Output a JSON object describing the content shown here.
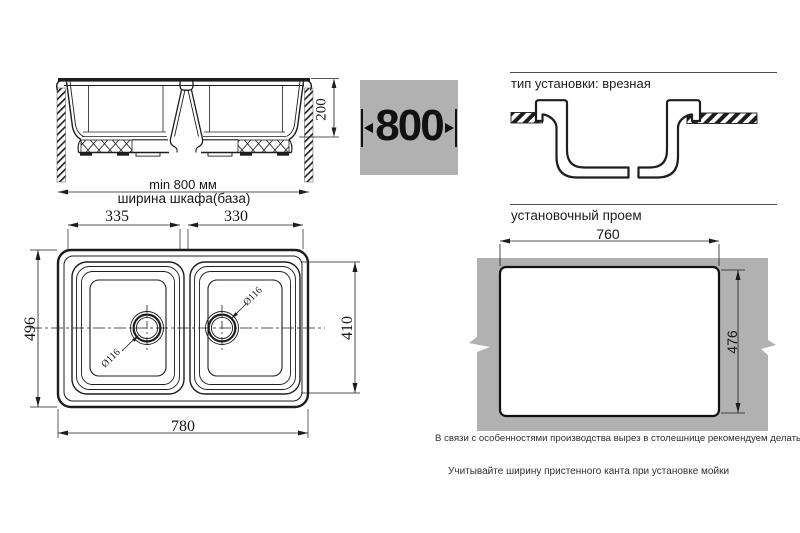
{
  "colors": {
    "surface_gray": "#b1b1b1",
    "line": "#1d1d1d"
  },
  "side_view": {
    "depth": "200",
    "min_width": "min 800 мм",
    "cabinet": "ширина шкафа(база)"
  },
  "size_box": {
    "width": "800"
  },
  "install": {
    "heading": "тип установки: врезная"
  },
  "opening": {
    "heading": "установочный проем",
    "width": "760",
    "height": "476"
  },
  "top_view": {
    "left_bowl": "335",
    "right_bowl": "330",
    "depth": "496",
    "bowl_depth": "410",
    "width": "780",
    "drain_left": "Ø116",
    "drain_right": "Ø116"
  },
  "notes": {
    "production": "В связи с особенностями производства вырез в столешнице рекомендуем делать с изделия.",
    "install_hint": "Учитывайте ширину пристенного канта при установке мойки"
  }
}
